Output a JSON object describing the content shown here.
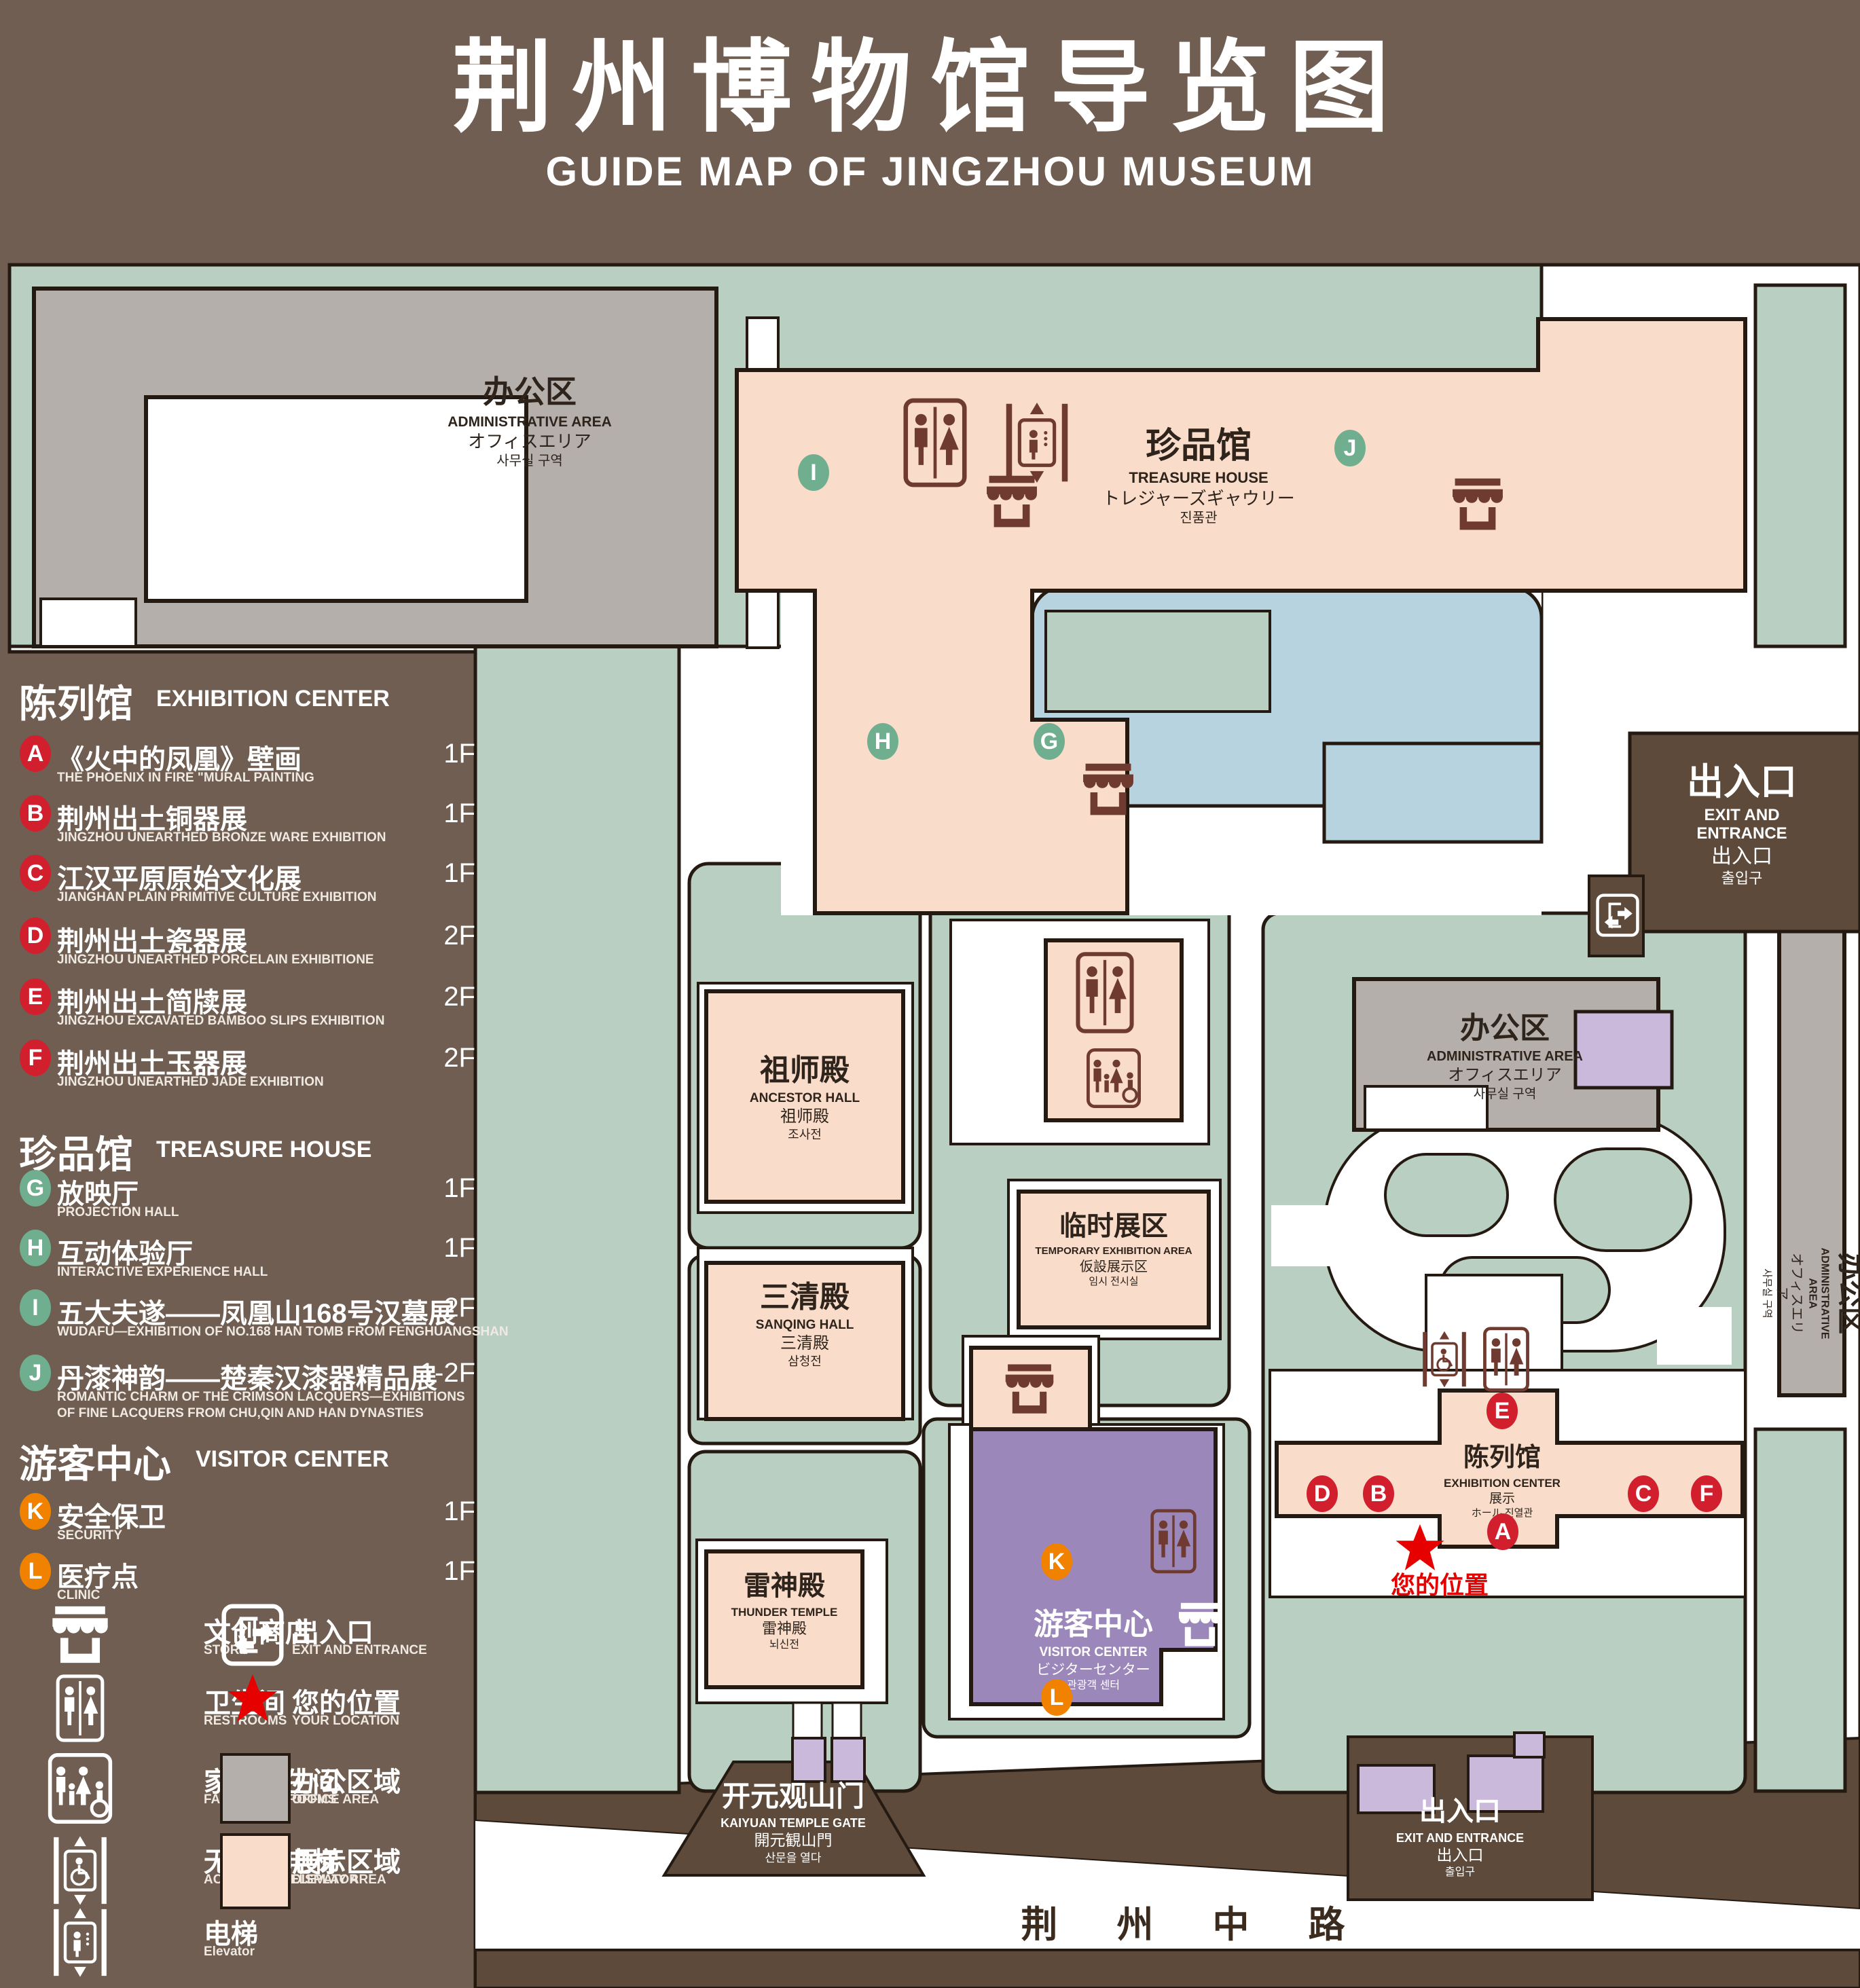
{
  "title": {
    "zh": "荆州博物馆导览图",
    "en": "GUIDE MAP OF JINGZHOU MUSEUM"
  },
  "colors": {
    "background": "#6F5E51",
    "green_area": "#B9CFC1",
    "display_area_pink": "#F9DDCA",
    "office_area_gray": "#B5AFAB",
    "pond_blue": "#B7D3DF",
    "purple_building": "#CBB9DC",
    "visitor_center_purple": "#9C87BA",
    "road_brown": "#5E4A3A",
    "icon_maroon": "#6F3B30",
    "badge_red": "#D21F2E",
    "badge_green": "#6FAE8E",
    "badge_orange": "#F08200",
    "location_star_red": "#E60000",
    "outline": "#241A12"
  },
  "legend": {
    "sections": [
      {
        "zh": "陈列馆",
        "en": "EXHIBITION CENTER",
        "items": [
          {
            "letter": "A",
            "color": "red",
            "zh": "《火中的凤凰》壁画",
            "en": "THE PHOENIX IN FIRE \"MURAL PAINTING",
            "floor": "1F"
          },
          {
            "letter": "B",
            "color": "red",
            "zh": "荆州出土铜器展",
            "en": "JINGZHOU UNEARTHED BRONZE WARE EXHIBITION",
            "floor": "1F"
          },
          {
            "letter": "C",
            "color": "red",
            "zh": "江汉平原原始文化展",
            "en": "JIANGHAN PLAIN PRIMITIVE CULTURE EXHIBITION",
            "floor": "1F"
          },
          {
            "letter": "D",
            "color": "red",
            "zh": "荆州出土瓷器展",
            "en": "JINGZHOU UNEARTHED PORCELAIN EXHIBITIONE",
            "floor": "2F"
          },
          {
            "letter": "E",
            "color": "red",
            "zh": "荆州出土简牍展",
            "en": "JINGZHOU EXCAVATED BAMBOO SLIPS EXHIBITION",
            "floor": "2F"
          },
          {
            "letter": "F",
            "color": "red",
            "zh": "荆州出土玉器展",
            "en": "JINGZHOU UNEARTHED JADE EXHIBITION",
            "floor": "2F"
          }
        ]
      },
      {
        "zh": "珍品馆",
        "en": "TREASURE HOUSE",
        "items": [
          {
            "letter": "G",
            "color": "green",
            "zh": "放映厅",
            "en": "PROJECTION HALL",
            "floor": "1F"
          },
          {
            "letter": "H",
            "color": "green",
            "zh": "互动体验厅",
            "en": "INTERACTIVE EXPERIENCE HALL",
            "floor": "1F"
          },
          {
            "letter": "I",
            "color": "green",
            "zh": "五大夫遂——凤凰山168号汉墓展",
            "en": "WUDAFU—EXHIBITION OF NO.168 HAN TOMB FROM FENGHUANGSHAN",
            "floor": "2F"
          },
          {
            "letter": "J",
            "color": "green",
            "zh": "丹漆神韵——楚秦汉漆器精品展",
            "en": "ROMANTIC CHARM OF THE CRIMSON LACQUERS—EXHIBITIONS\nOF FINE LACQUERS FROM CHU,QIN AND HAN DYNASTIES",
            "floor": "1-2F"
          }
        ]
      },
      {
        "zh": "游客中心",
        "en": "VISITOR CENTER",
        "items": [
          {
            "letter": "K",
            "color": "orange",
            "zh": "安全保卫",
            "en": "SECURITY",
            "floor": "1F"
          },
          {
            "letter": "L",
            "color": "orange",
            "zh": "医疗点",
            "en": "CLINIC",
            "floor": "1F"
          }
        ]
      }
    ],
    "symbols": [
      {
        "icon": "store-icon",
        "zh": "文创商店",
        "en": "STORE"
      },
      {
        "icon": "exit-icon",
        "zh": "出入口",
        "en": "EXIT AND ENTRANCE"
      },
      {
        "icon": "restroom-icon",
        "zh": "卫生间",
        "en": "RESTROOMS"
      },
      {
        "icon": "location-star-icon",
        "zh": "您的位置",
        "en": "YOUR LOCATION"
      },
      {
        "icon": "family-restroom-icon",
        "zh": "家庭卫生间",
        "en": "FAMILY RESTROOMS"
      },
      {
        "icon": "office-area-swatch",
        "zh": "办公区域",
        "en": "OFFICE AREA"
      },
      {
        "icon": "accessible-elevator-icon",
        "zh": "无障碍电梯",
        "en": "ACCESSIBLE ELEVATOR"
      },
      {
        "icon": "display-area-swatch",
        "zh": "展示区域",
        "en": "DISPLAY AREA"
      },
      {
        "icon": "elevator-icon",
        "zh": "电梯",
        "en": "Elevator"
      }
    ]
  },
  "map": {
    "buildings": {
      "admin_top_left": {
        "lines": [
          "办公区",
          "ADMINISTRATIVE AREA",
          "オフィスエリア",
          "사무실 구역"
        ]
      },
      "treasure_house": {
        "lines": [
          "珍品馆",
          "TREASURE HOUSE",
          "トレジャーズギャウリー",
          "진품관"
        ]
      },
      "exit_top_right": {
        "lines": [
          "出入口",
          "EXIT AND ENTRANCE",
          "出入口",
          "출입구"
        ]
      },
      "admin_right": {
        "lines": [
          "办公区",
          "ADMINISTRATIVE AREA",
          "オフィスエリア",
          "사무실 구역"
        ]
      },
      "admin_right_vertical": {
        "lines": [
          "办公区",
          "ADMINISTRATIVE AREA",
          "オフィスエリア",
          "사무실 구역"
        ]
      },
      "ancestor_hall": {
        "lines": [
          "祖师殿",
          "ANCESTOR HALL",
          "祖师殿",
          "조사전"
        ]
      },
      "temporary_exhibition": {
        "lines": [
          "临时展区",
          "TEMPORARY EXHIBITION AREA",
          "仮設展示区",
          "임시 전시실"
        ]
      },
      "sanqing_hall": {
        "lines": [
          "三清殿",
          "SANQING HALL",
          "三清殿",
          "삼청전"
        ]
      },
      "thunder_temple": {
        "lines": [
          "雷神殿",
          "THUNDER TEMPLE",
          "雷神殿",
          "뇌신전"
        ]
      },
      "visitor_center": {
        "lines": [
          "游客中心",
          "VISITOR CENTER",
          "ビジターセンター",
          "관광객 센터"
        ]
      },
      "exhibition_center": {
        "lines": [
          "陈列馆",
          "EXHIBITION CENTER",
          "展示",
          "ホール 진열관"
        ]
      },
      "kaiyuan_gate": {
        "lines": [
          "开元观山门",
          "KAIYUAN TEMPLE GATE",
          "開元観山門",
          "산문을 열다"
        ]
      },
      "exit_bottom": {
        "lines": [
          "出入口",
          "EXIT AND ENTRANCE",
          "出入口",
          "출입구"
        ]
      }
    },
    "markers": [
      {
        "letter": "A",
        "color": "red"
      },
      {
        "letter": "B",
        "color": "red"
      },
      {
        "letter": "C",
        "color": "red"
      },
      {
        "letter": "D",
        "color": "red"
      },
      {
        "letter": "E",
        "color": "red"
      },
      {
        "letter": "F",
        "color": "red"
      },
      {
        "letter": "G",
        "color": "green"
      },
      {
        "letter": "H",
        "color": "green"
      },
      {
        "letter": "I",
        "color": "green"
      },
      {
        "letter": "J",
        "color": "green"
      },
      {
        "letter": "K",
        "color": "orange"
      },
      {
        "letter": "L",
        "color": "orange"
      }
    ],
    "your_location_label": "您的位置",
    "road_name": "荆 州 中 路"
  }
}
